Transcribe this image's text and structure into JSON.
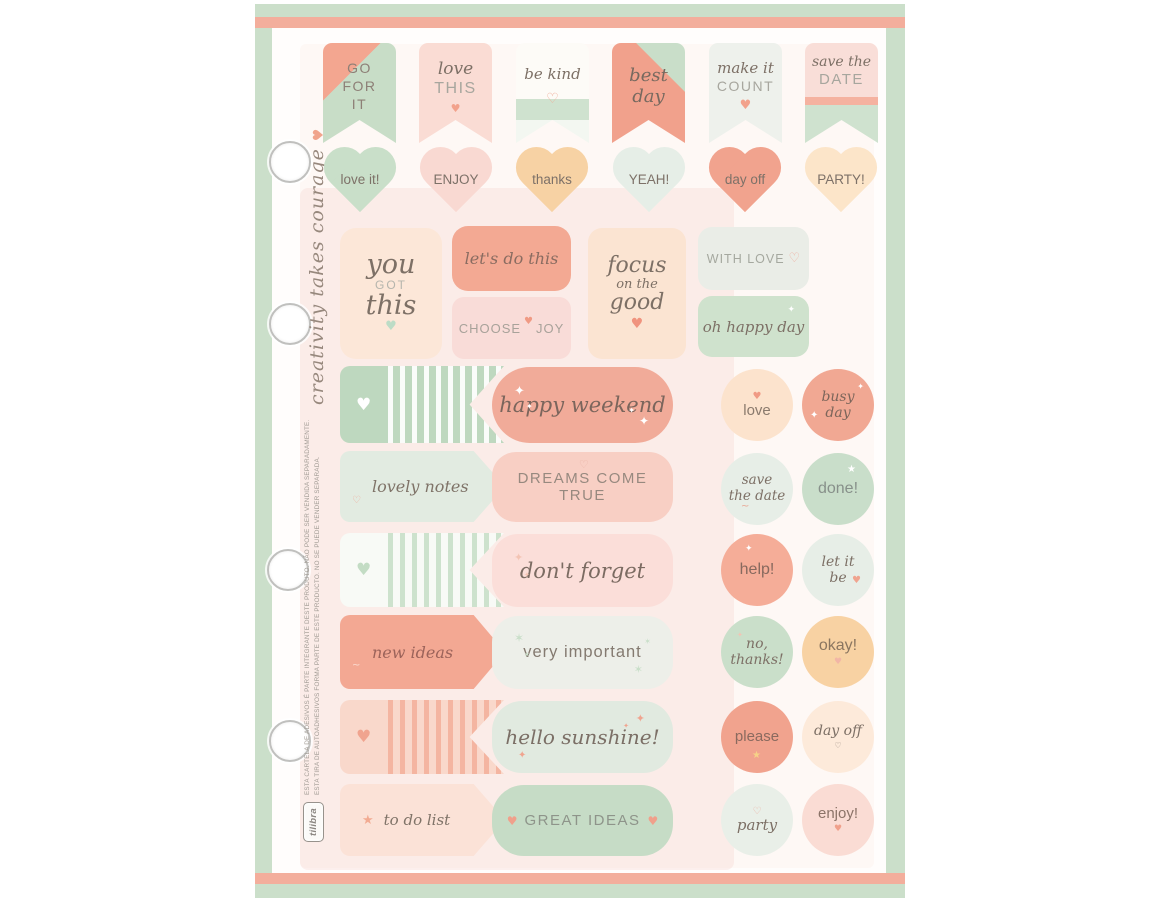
{
  "sheet": {
    "border_color": "#cbdfca",
    "accent_bar_color": "#f3ae9c",
    "paper_color": "#fffdfc",
    "binder_holes": 4,
    "side": {
      "website": "www.tilibra.com.br",
      "quote": "creativity takes courage",
      "legal_pt": "ESTA CARTELA DE ADESIVOS É PARTE INTEGRANTE DESTE PRODUTO. NÃO PODE SER VENDIDA SEPARADAMENTE.",
      "legal_es": "ESTA TIRA DE AUTOADHESIVOS FORMA PARTE DE ESTE PRODUCTO. NO SE PUEDE VENDER SEPARADA.",
      "brand": "tilibra"
    }
  },
  "glyphs": {
    "heart": "♥",
    "heart_outline": "♡",
    "star": "★",
    "sparkle": "✦",
    "star4": "✶",
    "swash": "~"
  },
  "palette": {
    "mint": "#c6dcc6",
    "mint_light": "#e7eee7",
    "coral": "#f1a78f",
    "blush": "#f9dcd4",
    "peach": "#f8d2a3",
    "peach_light": "#fce5cd",
    "text": "#7d7066",
    "text_muted": "#a7a69e"
  },
  "flags": [
    {
      "l1": "GO",
      "l2": "FOR",
      "l3": "IT"
    },
    {
      "script": "love",
      "caps": "THIS",
      "heart": "♥"
    },
    {
      "script": "be kind",
      "heart": "♡"
    },
    {
      "l1": "best",
      "l2": "day"
    },
    {
      "script": "make it",
      "caps": "COUNT",
      "heart": "♥"
    },
    {
      "script": "save the",
      "caps": "DATE"
    }
  ],
  "hearts": [
    {
      "label": "love it!",
      "color": "#c9dfc9"
    },
    {
      "label": "ENJOY",
      "color": "#f9d9d2"
    },
    {
      "label": "thanks",
      "color": "#f7d2a4"
    },
    {
      "label": "YEAH!",
      "color": "#e6eee7"
    },
    {
      "label": "day off",
      "color": "#f1a38e"
    },
    {
      "label": "PARTY!",
      "color": "#fce5c9"
    }
  ],
  "cards": [
    {
      "l1": "you",
      "l2": "GOT",
      "l3": "this",
      "heart": "♥"
    },
    {
      "text": "let's do this"
    },
    {
      "w1": "CHOOSE",
      "heart": "♥",
      "w2": "JOY"
    },
    {
      "l1": "focus",
      "l2": "on the",
      "l3": "good",
      "heart": "♥"
    },
    {
      "text": "WITH LOVE",
      "heart": "♡"
    },
    {
      "text": "oh happy day",
      "star": "✦"
    }
  ],
  "rows": [
    {
      "banner_heart": "♥",
      "pill": "happy weekend",
      "c1_text": "love",
      "c1_heart": "♥",
      "c2_l1": "busy",
      "c2_l2": "day"
    },
    {
      "banner": "lovely notes",
      "pill": "DREAMS COME TRUE",
      "pill_heart": "♡",
      "c1_l1": "save",
      "c1_l2": "the date",
      "c2_text": "done!",
      "c2_star": "★"
    },
    {
      "banner_heart": "♥",
      "pill": "don't forget",
      "c1_text": "help!",
      "c2_l1": "let it",
      "c2_l2": "be",
      "c2_heart": "♥"
    },
    {
      "banner": "new ideas",
      "pill": "very important",
      "c1_l1": "no,",
      "c1_l2": "thanks!",
      "c2_text": "okay!",
      "c2_heart": "♥"
    },
    {
      "banner_heart": "♥",
      "pill": "hello sunshine!",
      "c1_text": "please",
      "c1_star": "★",
      "c2_text": "day off",
      "c2_heart": "♡"
    },
    {
      "banner": "to do list",
      "banner_star": "★",
      "pill": "GREAT IDEAS",
      "pill_heart_left": "♥",
      "pill_heart_right": "♥",
      "c1_text": "party",
      "c1_heart": "♡",
      "c2_text": "enjoy!",
      "c2_heart": "♥"
    }
  ]
}
